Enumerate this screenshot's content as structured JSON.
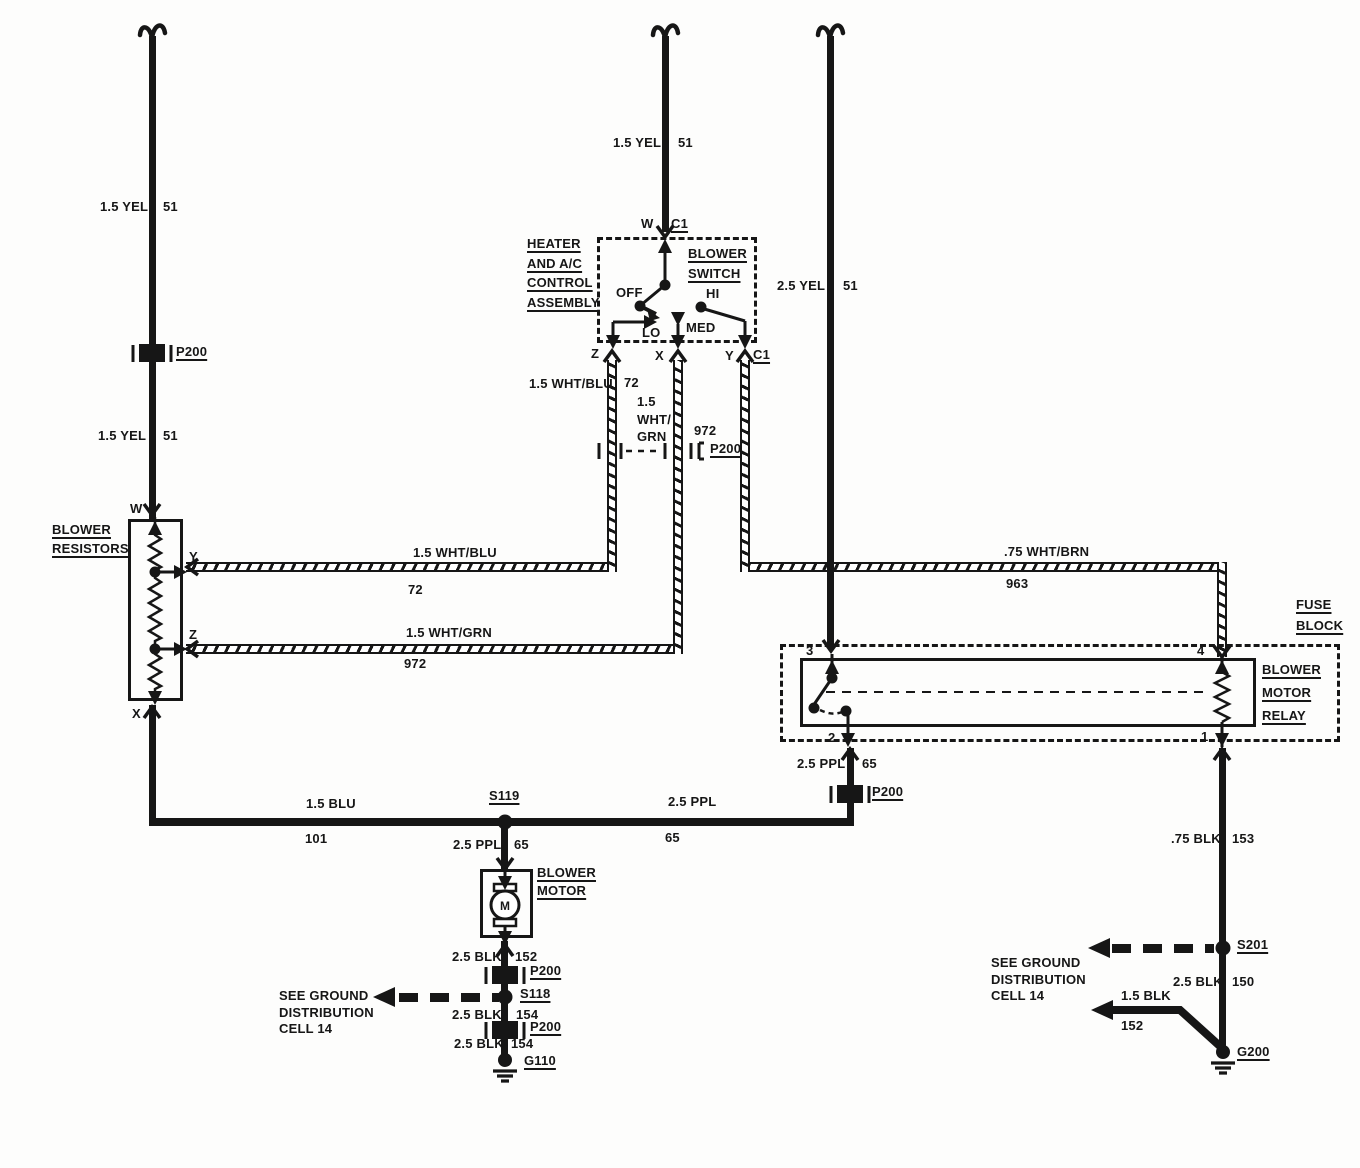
{
  "title": "Blower motor circuit wiring diagram",
  "colors": {
    "ink": "#161616",
    "paper": "#fdfdfc"
  },
  "components": {
    "heater_control": [
      "HEATER",
      "AND A/C",
      "CONTROL",
      "ASSEMBLY"
    ],
    "blower_switch": [
      "BLOWER",
      "SWITCH"
    ],
    "blower_resistors": [
      "BLOWER",
      "RESISTORS"
    ],
    "fuse_block": [
      "FUSE",
      "BLOCK"
    ],
    "blower_motor_relay": [
      "BLOWER",
      "MOTOR",
      "RELAY"
    ],
    "blower_motor": [
      "BLOWER",
      "MOTOR"
    ],
    "motor_symbol": "M"
  },
  "switch": {
    "term_w": "W",
    "conn_top": "C1",
    "pos_off": "OFF",
    "pos_lo": "LO",
    "pos_med": "MED",
    "pos_hi": "HI",
    "term_z": "Z",
    "term_x": "X",
    "term_y": "Y",
    "conn_bottom": "C1"
  },
  "resistors": {
    "term_w": "W",
    "term_y": "Y",
    "term_z": "Z",
    "term_x": "X"
  },
  "relay": {
    "t1": "1",
    "t2": "2",
    "t3": "3",
    "t4": "4"
  },
  "wires": {
    "yel_left_upper": {
      "gauge": "1.5 YEL",
      "circuit": "51"
    },
    "yel_left_lower": {
      "gauge": "1.5 YEL",
      "circuit": "51"
    },
    "yel_switch": {
      "gauge": "1.5 YEL",
      "circuit": "51"
    },
    "yel_relay": {
      "gauge": "2.5 YEL",
      "circuit": "51"
    },
    "whtblu_drop": {
      "gauge": "1.5 WHT/BLU",
      "circuit": "72"
    },
    "whtgrn_drop": {
      "gauge": [
        "1.5",
        "WHT/",
        "GRN"
      ],
      "circuit": "972"
    },
    "whtblu_run": {
      "gauge": "1.5 WHT/BLU",
      "circuit": "72"
    },
    "whtgrn_run": {
      "gauge": "1.5 WHT/GRN",
      "circuit": "972"
    },
    "whtbrn_run": {
      "gauge": ".75 WHT/BRN",
      "circuit": "963"
    },
    "blu_run": {
      "gauge": "1.5 BLU",
      "circuit": "101"
    },
    "ppl_run": {
      "gauge": "2.5 PPL",
      "circuit": "65"
    },
    "ppl_riser": {
      "gauge": "2.5 PPL",
      "circuit": "65"
    },
    "ppl_branch": {
      "gauge": "2.5 PPL",
      "circuit": "65"
    },
    "blk_motor": {
      "gauge": "2.5 BLK",
      "circuit": "152"
    },
    "blk_154_upper": {
      "gauge": "2.5 BLK",
      "circuit": "154"
    },
    "blk_154_lower": {
      "gauge": "2.5 BLK",
      "circuit": "154"
    },
    "blk_relay": {
      "gauge": ".75 BLK",
      "circuit": "153"
    },
    "blk_150": {
      "gauge": "2.5 BLK",
      "circuit": "150"
    },
    "blk_152_right": {
      "gauge": "1.5 BLK",
      "circuit": "152"
    }
  },
  "connectors": {
    "p200_yel": "P200",
    "p200_pair": "P200",
    "p200_ppl": "P200",
    "p200_blk_upper": "P200",
    "p200_blk_lower": "P200"
  },
  "junctions": {
    "s119": "S119",
    "s118": "S118",
    "s201": "S201"
  },
  "grounds": {
    "g110": "G110",
    "g200": "G200"
  },
  "ground_refs": {
    "left": [
      "SEE GROUND",
      "DISTRIBUTION",
      "CELL 14"
    ],
    "right": [
      "SEE GROUND",
      "DISTRIBUTION",
      "CELL 14"
    ]
  }
}
